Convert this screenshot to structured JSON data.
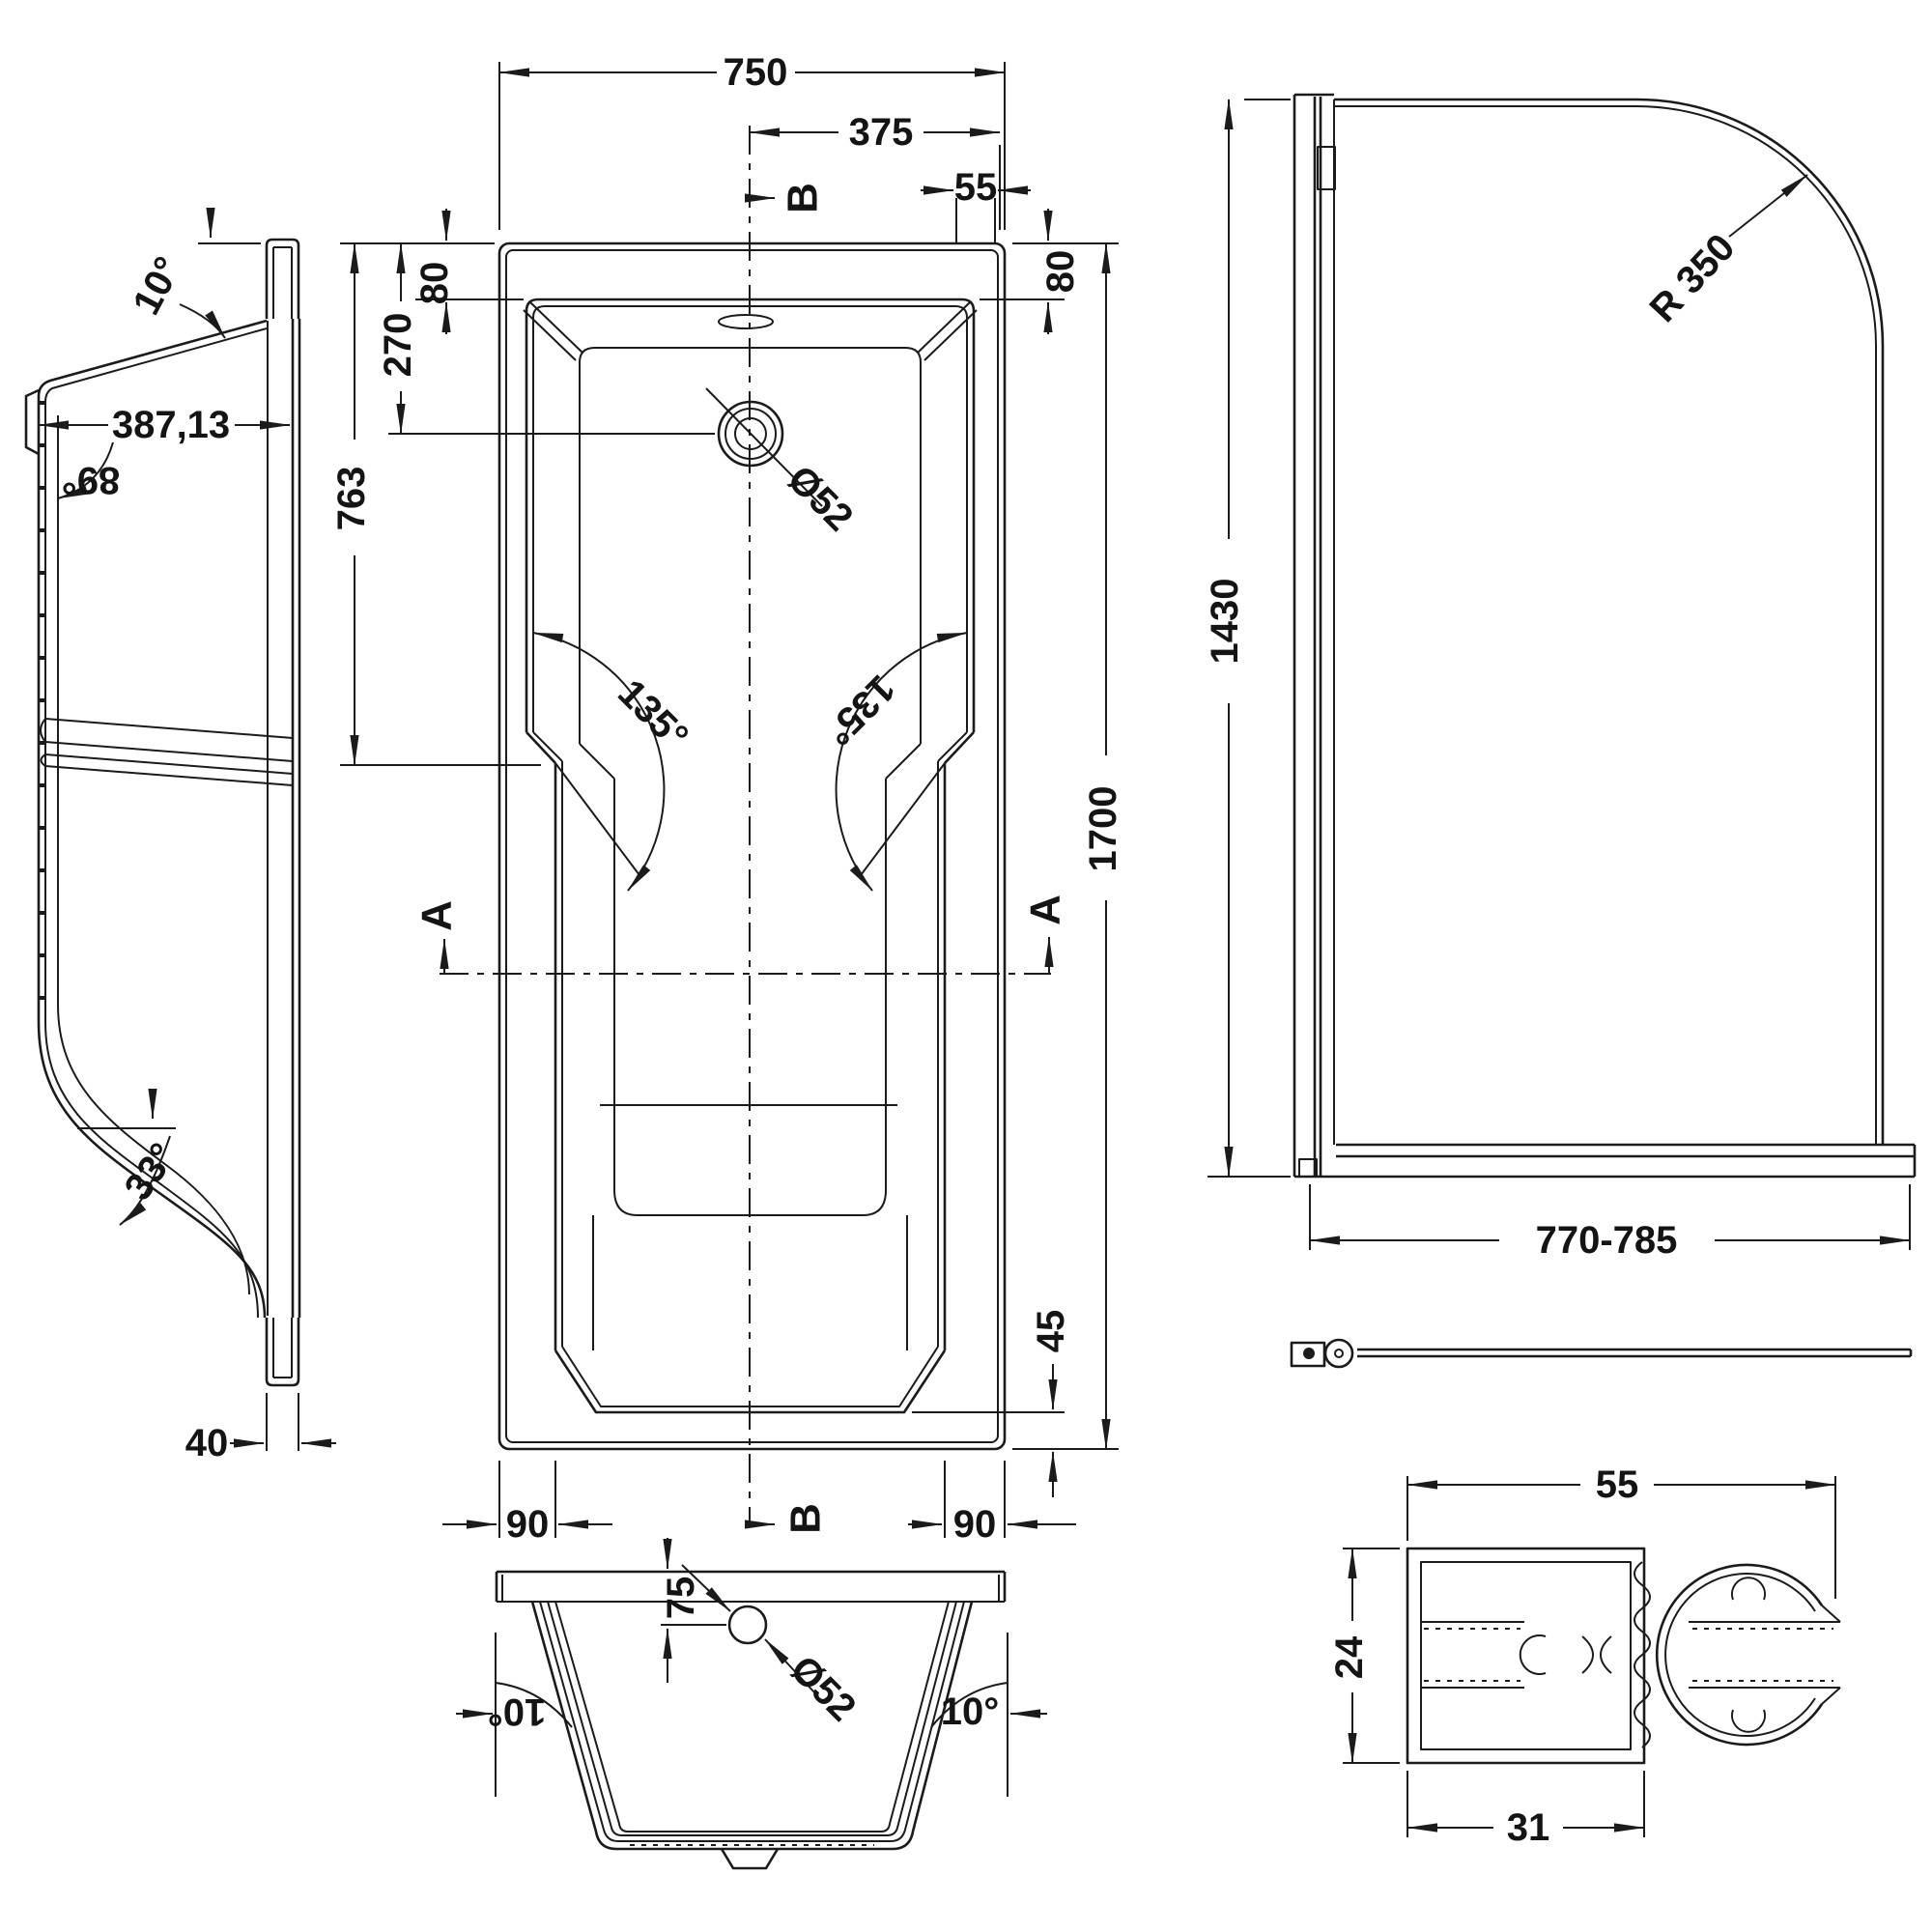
{
  "drawing": {
    "subject": "Shower bath and curved bath-screen technical drawing",
    "background": "#ffffff",
    "line_color": "#1b1b1b"
  },
  "side_view": {
    "top_angle": "10°",
    "depth": "387,13",
    "wall_angle": "89°",
    "bottom_angle": "33°",
    "base_offset": "40"
  },
  "plan_view": {
    "overall_width": "750",
    "center_to_edge": "375",
    "corner_offset": "55",
    "rim_width_left": "80",
    "rim_width_right": "80",
    "drain_from_head": "270",
    "head_to_taper": "763",
    "overall_length": "1700",
    "taper_angle_left": "135°",
    "taper_angle_right": "135°",
    "drain_diameter": "Ø52",
    "foot_corner_left": "90",
    "foot_corner_right": "90",
    "foot_rim": "45",
    "section_label_a": "A",
    "section_label_b": "B"
  },
  "screen_elevation": {
    "height": "1430",
    "corner_radius": "R 350",
    "width_range": "770-785"
  },
  "section_view": {
    "overflow_depth": "75",
    "drain_diameter": "Ø52",
    "wall_angle_left": "10°",
    "wall_angle_right": "10°"
  },
  "profile_detail": {
    "overall_width": "55",
    "height": "24",
    "channel_width": "31"
  }
}
